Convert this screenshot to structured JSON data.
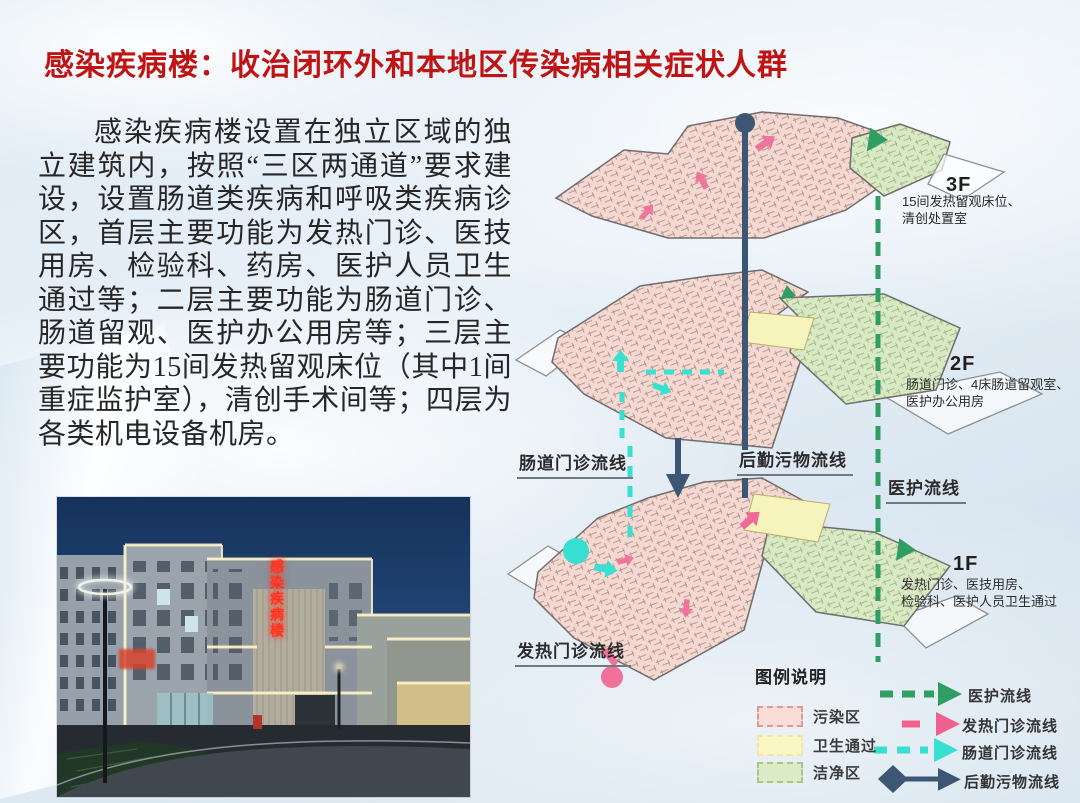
{
  "slide": {
    "title": "感染疾病楼：收治闭环外和本地区传染病相关症状人群",
    "body": "感染疾病楼设置在独立区域的独立建筑内，按照“三区两通道”要求建设，设置肠道类疾病和呼吸类疾病诊区，首层主要功能为发热门诊、医技用房、检验科、药房、医护人员卫生通过等；二层主要功能为肠道门诊、肠道留观、医护办公用房等；三层主要功能为15间发热留观床位（其中1间重症监护室），清创手术间等；四层为各类机电设备机房。"
  },
  "photo": {
    "building_sign": "感染疾病楼"
  },
  "floors": [
    {
      "label": "3F",
      "description": "15间发热留观床位、\n清创处置室"
    },
    {
      "label": "2F",
      "description": "肠道门诊、4床肠道留观室、\n医护办公用房"
    },
    {
      "label": "1F",
      "description": "发热门诊、医技用房、\n检验科、医护人员卫生通过"
    }
  ],
  "flow_labels": {
    "intestinal": "肠道门诊流线",
    "logistics": "后勤污物流线",
    "medical": "医护流线",
    "fever": "发热门诊流线"
  },
  "legend": {
    "title": "图例说明",
    "zones": [
      {
        "label": "污染区",
        "fill": "#f8ded7",
        "border": "#e09a90"
      },
      {
        "label": "卫生通过",
        "fill": "#f9f6c3",
        "border": "#eee8ad"
      },
      {
        "label": "洁净区",
        "fill": "#dcebc5",
        "border": "#a8c687"
      }
    ],
    "flows": [
      {
        "label": "医护流线",
        "color": "#2f9e62"
      },
      {
        "label": "发热门诊流线",
        "color": "#f0618f"
      },
      {
        "label": "肠道门诊流线",
        "color": "#38e0d2"
      },
      {
        "label": "后勤污物流线",
        "color": "#3d5674"
      }
    ]
  },
  "colors": {
    "title": "#c01414",
    "zone_pink": "#f4d9d3",
    "zone_green": "#d9e9c4",
    "zone_yellow": "#f7f3bd",
    "navy_line": "#3d5674",
    "green_line": "#2f9e62",
    "cyan_line": "#38e0d2",
    "pink_line": "#f0618f"
  }
}
